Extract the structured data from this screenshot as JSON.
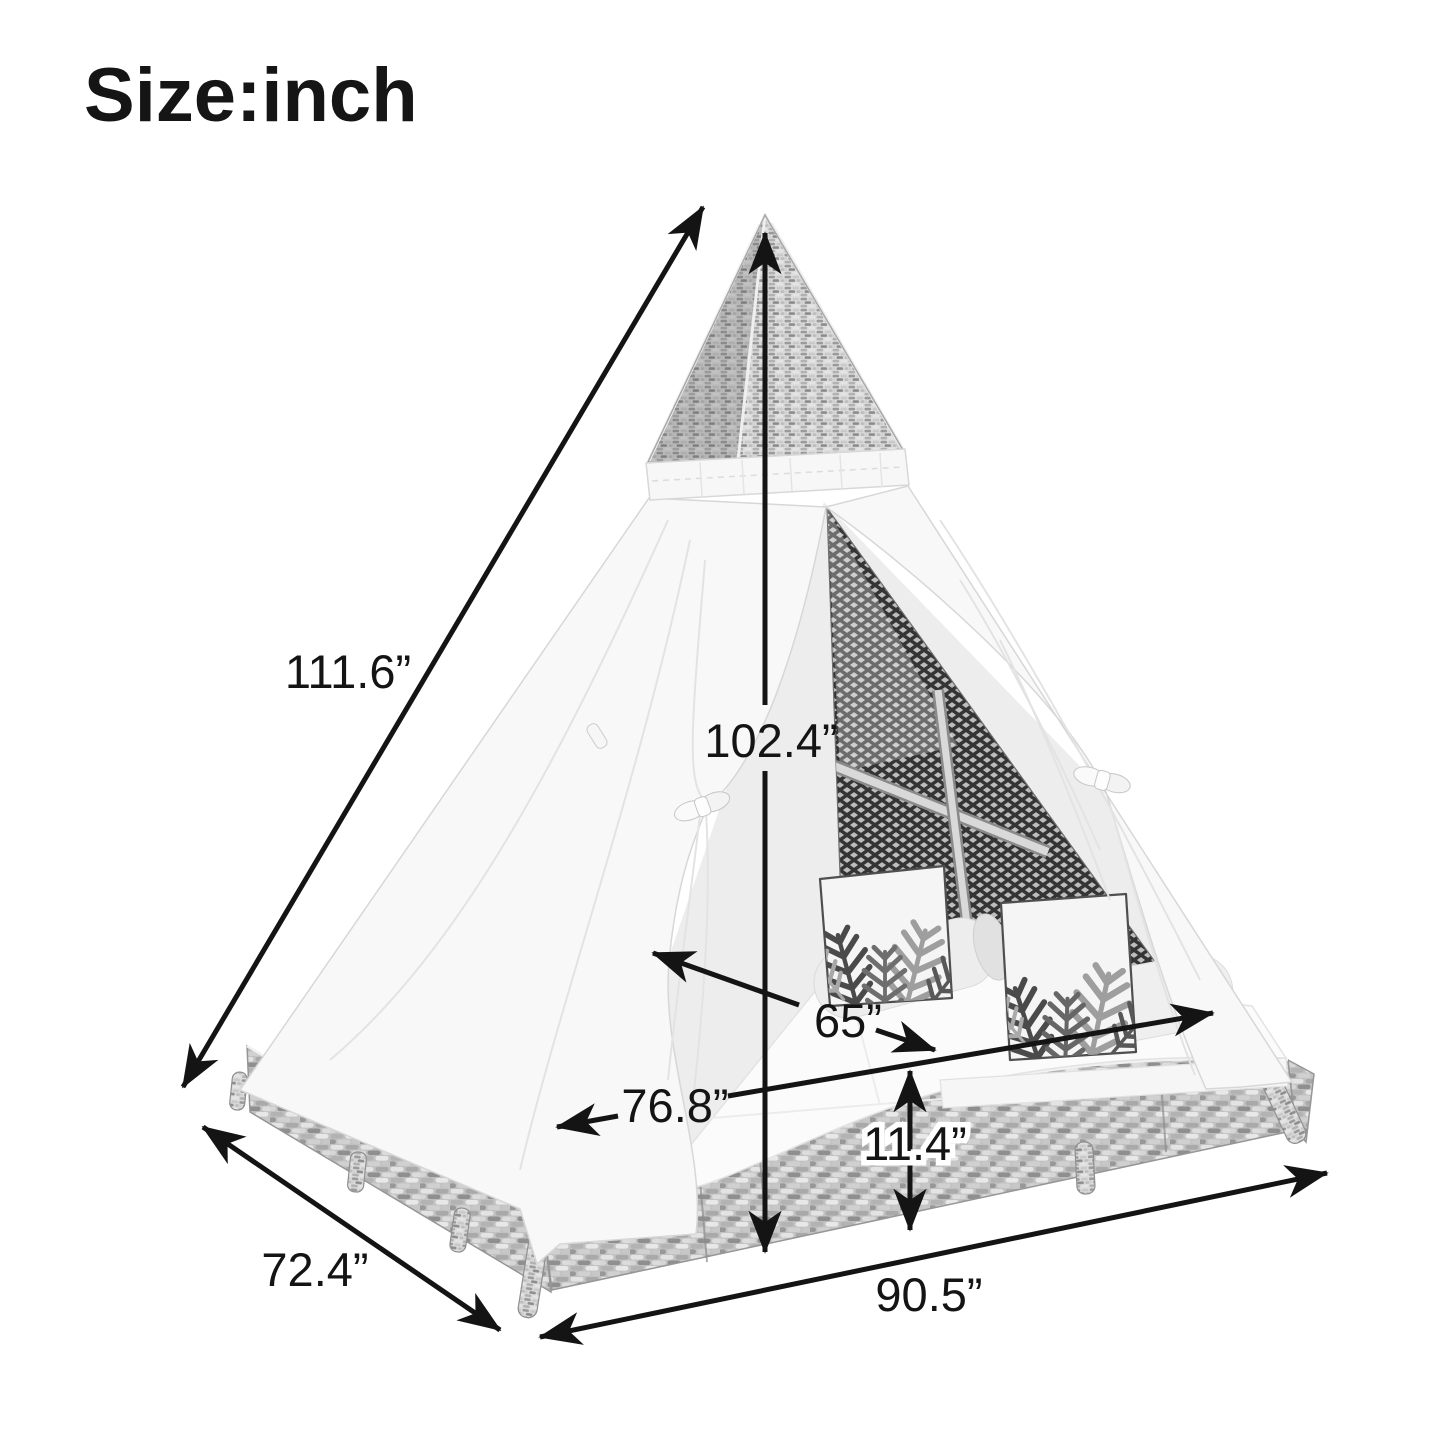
{
  "title": "Size:inch",
  "unit": "inch",
  "labels": {
    "slant_height": "111.6”",
    "center_height": "102.4”",
    "bed_width": "65”",
    "bed_depth": "76.8”",
    "base_height": "11.4”",
    "side_width": "72.4”",
    "front_width": "90.5”"
  },
  "colors": {
    "ink": "#141414",
    "background": "#ffffff",
    "canvas": "#f8f8f8",
    "wicker_light": "#dcdcdc",
    "wicker_dark": "#8f8f8f",
    "mesh_dark": "#343434"
  }
}
